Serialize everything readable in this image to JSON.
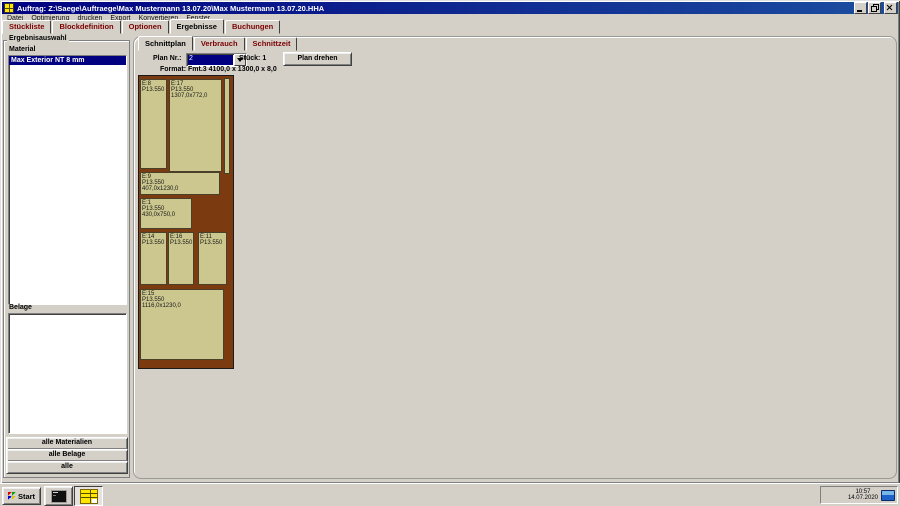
{
  "window": {
    "title": "Auftrag: Z:\\Saege\\Auftraege\\Max Mustermann 13.07.20\\Max Mustermann 13.07.20.HHA"
  },
  "menu": {
    "items": [
      "Datei",
      "Optimierung",
      "drucken",
      "Export",
      "Konvertieren",
      "Fenster"
    ]
  },
  "main_tabs": [
    {
      "label": "Stückliste"
    },
    {
      "label": "Blockdefinition"
    },
    {
      "label": "Optionen"
    },
    {
      "label": "Ergebnisse"
    },
    {
      "label": "Buchungen"
    }
  ],
  "sidebar": {
    "group_label": "Ergebnisauswahl",
    "material_label": "Material",
    "material_selected": "Max Exterior NT 8 mm",
    "belage_label": "Belage",
    "buttons": {
      "all_materials": "alle Materialien",
      "all_belage": "alle Belage",
      "all": "alle"
    }
  },
  "results": {
    "tabs": [
      {
        "label": "Schnittplan"
      },
      {
        "label": "Verbrauch"
      },
      {
        "label": "Schnittzeit"
      }
    ],
    "plan_nr_label": "Plan Nr.:",
    "plan_nr_value": "2",
    "stueck_text": "Stück: 1",
    "rotate_button": "Plan drehen",
    "format_text": "Format: Fmt.3 4100,0 x 1300,0 x 8,0"
  },
  "plan": {
    "board_format": "4100,0 x 1300,0 x 8,0",
    "colors": {
      "waste": "#7c3a10",
      "piece": "#cbc78e",
      "border": "#4a4028"
    },
    "pieces": [
      {
        "id": "E:8",
        "pos": "P13.550",
        "dims": ""
      },
      {
        "id": "E:17",
        "pos": "P13.550",
        "dims": "1307,0x772,0"
      },
      {
        "id": "E:9",
        "pos": "P13.550",
        "dims": "407,0x1230,0"
      },
      {
        "id": "E:1",
        "pos": "P13.550",
        "dims": "430,0x750,0"
      },
      {
        "id": "E:14",
        "pos": "P13.550",
        "dims": ""
      },
      {
        "id": "E:16",
        "pos": "P13.550",
        "dims": ""
      },
      {
        "id": "E:11",
        "pos": "P13.550",
        "dims": ""
      },
      {
        "id": "E:15",
        "pos": "P13.550",
        "dims": "1116,0x1230,0"
      }
    ]
  },
  "taskbar": {
    "start_label": "Start",
    "clock_time": "10:57",
    "clock_date": "14.07.2020"
  }
}
